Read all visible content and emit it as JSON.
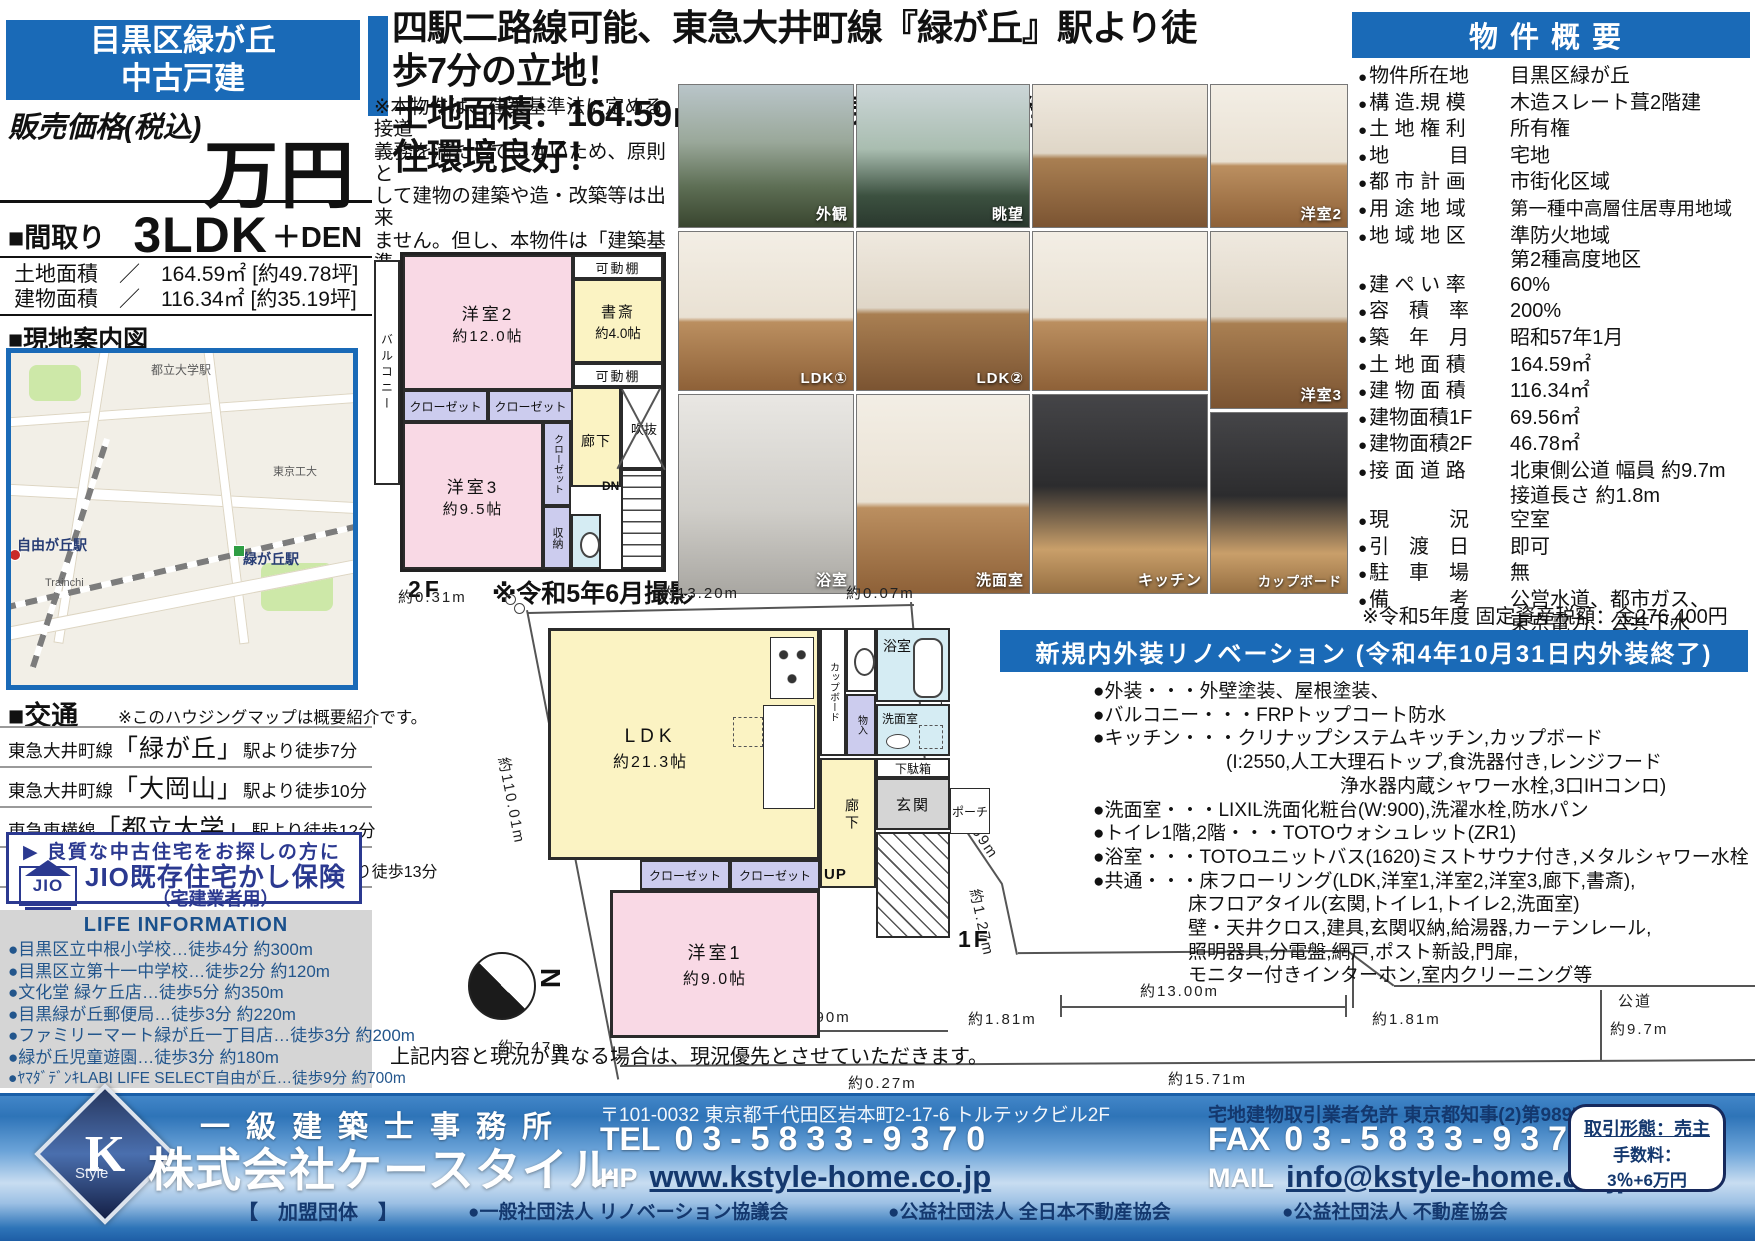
{
  "badge": {
    "line1": "目黒区緑が丘",
    "line2": "中古戸建"
  },
  "price": {
    "label": "販売価格(税込)",
    "unit": "万円"
  },
  "madori": {
    "label": "■間取り",
    "value": "3LDK",
    "suffix": "＋DEN"
  },
  "areas": {
    "land": "土地面積　／　164.59㎡ [約49.78坪]",
    "building": "建物面積　／　116.34㎡ [約35.19坪]"
  },
  "map_section": {
    "title": "■現地案内図",
    "labels": {
      "station_toritsudaigaku": "都立大学駅",
      "station_jiyugaoka": "自由が丘駅",
      "station_midorigaoka": "緑が丘駅",
      "tokyo_tech": "東京工大",
      "trainchi": "Trainchi"
    }
  },
  "access": {
    "title": "■交通",
    "note": "※このハウジングマップは概要紹介です。",
    "routes": [
      {
        "line": "東急大井町線",
        "station": "「緑が丘」",
        "rest": "駅より徒歩7分"
      },
      {
        "line": "東急大井町線",
        "station": "「大岡山」",
        "rest": "駅より徒歩10分"
      },
      {
        "line": "東急東横線",
        "station": "「都立大学」",
        "rest": "駅より徒歩12分"
      },
      {
        "line": "東急東横線・大井町線",
        "station": "「自由が丘」",
        "rest": "駅より徒歩13分"
      }
    ]
  },
  "jio": {
    "lead": "▶ 良質な中古住宅をお探しの方に",
    "logo": "JIO",
    "main": "JIO既存住宅かし保険",
    "sub": "（宅建業者用）"
  },
  "life": {
    "title": "LIFE INFORMATION",
    "items": [
      "●目黒区立中根小学校…徒歩4分 約300m",
      "●目黒区立第十一中学校…徒歩2分 約120m",
      "●文化堂 緑ケ丘店…徒歩5分 約350m",
      "●目黒緑が丘郵便局…徒歩3分 約220m",
      "●ファミリーマート緑が丘一丁目店…徒歩3分 約200m",
      "●緑が丘児童遊園…徒歩3分 約180m",
      "●ﾔﾏﾀﾞﾃﾞﾝｷLABI LIFE SELECT自由が丘…徒歩9分 約700m"
    ]
  },
  "headline": {
    "line1": "四駅二路線可能、東急大井町線『緑が丘』駅より徒歩7分の立地！",
    "line2": "土地面積：164.59㎡、北側の閑静な住宅街につき、住環境良好！"
  },
  "note": "※本物件は、建築基準法に定める接道\n義務を満たしていないため、原則と\nして建物の建築や造・改築等は出来\nません。但し、本物件は「建築基準\n法第43条第2項第2号取り扱い方針」\nの基準を満たすことで再建築可能と\nの見解を得ています。",
  "photos": {
    "captions": [
      "外観",
      "眺望",
      "",
      "洋室2",
      "LDK①",
      "LDK②",
      "",
      "洋室3",
      "浴室",
      "洗面室",
      "キッチン",
      "カップボード"
    ]
  },
  "plan2f": {
    "floor": "2F",
    "photo_note": "※令和5年6月撮影",
    "balcony": "バルコニー",
    "room2": "洋室2",
    "room2_size": "約12.0帖",
    "shelf_top": "可動棚",
    "den": "書斎",
    "den_size": "約4.0帖",
    "shelf_bottom": "可動棚",
    "closet1": "クローゼット",
    "closet2": "クローゼット",
    "room3": "洋室3",
    "room3_size": "約9.5帖",
    "closet_v": "クローゼット",
    "hall": "廊下",
    "void": "吹抜",
    "dn": "DN",
    "storage": "収納"
  },
  "plan1f": {
    "floor": "1F",
    "ldk": "LDK",
    "ldk_size": "約21.3帖",
    "cupboard": "カップボード",
    "toilet": "トイレ",
    "mono": "物入",
    "bath": "浴室",
    "wash": "洗面室",
    "hall": "廊下",
    "shoe": "下駄箱",
    "entry": "玄関",
    "porch": "ポーチ",
    "up": "UP",
    "room1": "洋室1",
    "room1_size": "約9.0帖",
    "closet1": "クローゼット",
    "closet2": "クローゼット"
  },
  "site": {
    "dims": {
      "top": "約13.20m",
      "top_right": "約0.07m",
      "left_top": "約0.31m",
      "left_edge": "約110.01m",
      "right_edge": "約6.62m",
      "diag_a": "約3.59m",
      "diag_b": "約1.27m",
      "seg_a": "約1.81m",
      "frontage": "約13.00m",
      "seg_b": "約0.38m",
      "seg_c": "約6.90m",
      "seg_d": "約7.47m",
      "seg_e": "約0.27m",
      "bottom": "約15.71m",
      "seg_f": "約1.81m",
      "road": "公道",
      "road_width": "約9.7m"
    },
    "compass": "N"
  },
  "disclaimer": "上記内容と現況が異なる場合は、現況優先とさせていただきます。",
  "overview": {
    "title": "物件概要",
    "rows": [
      {
        "label": "物件所在地",
        "value": "目黒区緑が丘"
      },
      {
        "label": "構 造.規 模",
        "value": "木造スレート葺2階建"
      },
      {
        "label": "土 地 権 利",
        "value": "所有権"
      },
      {
        "label": "地　　　目",
        "value": "宅地"
      },
      {
        "label": "都 市 計 画",
        "value": "市街化区域"
      },
      {
        "label": "用 途 地 域",
        "value": "第一種中高層住居専用地域"
      },
      {
        "label": "地 域 地 区",
        "value": "準防火地域\n第2種高度地区"
      },
      {
        "label": "建 ぺ い 率",
        "value": "60%"
      },
      {
        "label": "容　積　率",
        "value": "200%"
      },
      {
        "label": "築　年　月",
        "value": "昭和57年1月"
      },
      {
        "label": "土 地 面 積",
        "value": "164.59㎡"
      },
      {
        "label": "建 物 面 積",
        "value": "116.34㎡"
      },
      {
        "label": "建物面積1F",
        "value": "69.56㎡"
      },
      {
        "label": "建物面積2F",
        "value": "46.78㎡"
      },
      {
        "label": "接 面 道 路",
        "value": "北東側公道 幅員 約9.7m\n接道長さ 約1.8m"
      },
      {
        "label": "現　　　況",
        "value": "空室"
      },
      {
        "label": "引　渡　日",
        "value": "即可"
      },
      {
        "label": "駐　車　場",
        "value": "無"
      },
      {
        "label": "備　　　考",
        "value": "公営水道、都市ガス、\n東京電力、公共下水"
      }
    ],
    "tax_note": "※令和5年度 固定資産税額：金276,400円"
  },
  "renovation": {
    "title": "新規内外装リノベーション (令和4年10月31日内外装終了)",
    "lines": [
      "●外装・・・外壁塗装、屋根塗装、",
      "●バルコニー・・・FRPトップコート防水",
      "●キッチン・・・クリナップシステムキッチン,カップボード",
      "　　　　　　　(I:2550,人工大理石トップ,食洗器付き,レンジフード",
      "　　　　　　　　　　　　　浄水器内蔵シャワー水栓,3口IHコンロ)",
      "●洗面室・・・LIXIL洗面化粧台(W:900),洗濯水栓,防水パン",
      "●トイレ1階,2階・・・TOTOウォシュレット(ZR1)",
      "●浴室・・・TOTOユニットバス(1620)ミストサウナ付き,メタルシャワー水栓",
      "●共通・・・床フローリング(LDK,洋室1,洋室2,洋室3,廊下,書斎),",
      "　　　　　床フロアタイル(玄関,トイレ1,トイレ2,洗面室)",
      "　　　　　壁・天井クロス,建具,玄関収納,給湯器,カーテンレール,",
      "　　　　　照明器具,分電盤,網戸,ポスト新設,門扉,",
      "　　　　　モニター付きインターホン,室内クリーニング等"
    ]
  },
  "footer": {
    "office_type": "一級建築士事務所",
    "company": "株式会社ケースタイル",
    "member_label": "【　加盟団体　】",
    "orgs": [
      "●一般社団法人 リノベーション協議会",
      "●公益社団法人 全日本不動産協会",
      "●公益社団法人 不動産協会"
    ],
    "address": "〒101-0032 東京都千代田区岩本町2-17-6 トルテックビル2F",
    "license": "宅地建物取引業者免許 東京都知事(2)第98978号",
    "tel_label": "TEL",
    "tel": "03-5833-9370",
    "fax_label": "FAX",
    "fax": "03-5833-9371",
    "hp_label": "HP",
    "hp": "www.kstyle-home.co.jp",
    "mail_label": "MAIL",
    "mail": "info@kstyle-home.co.jp",
    "deal": {
      "line1": "取引形態：売主",
      "line2": "手数料：",
      "line3": "3％+6万円"
    },
    "logo": {
      "k": "K",
      "style": "Style"
    }
  }
}
